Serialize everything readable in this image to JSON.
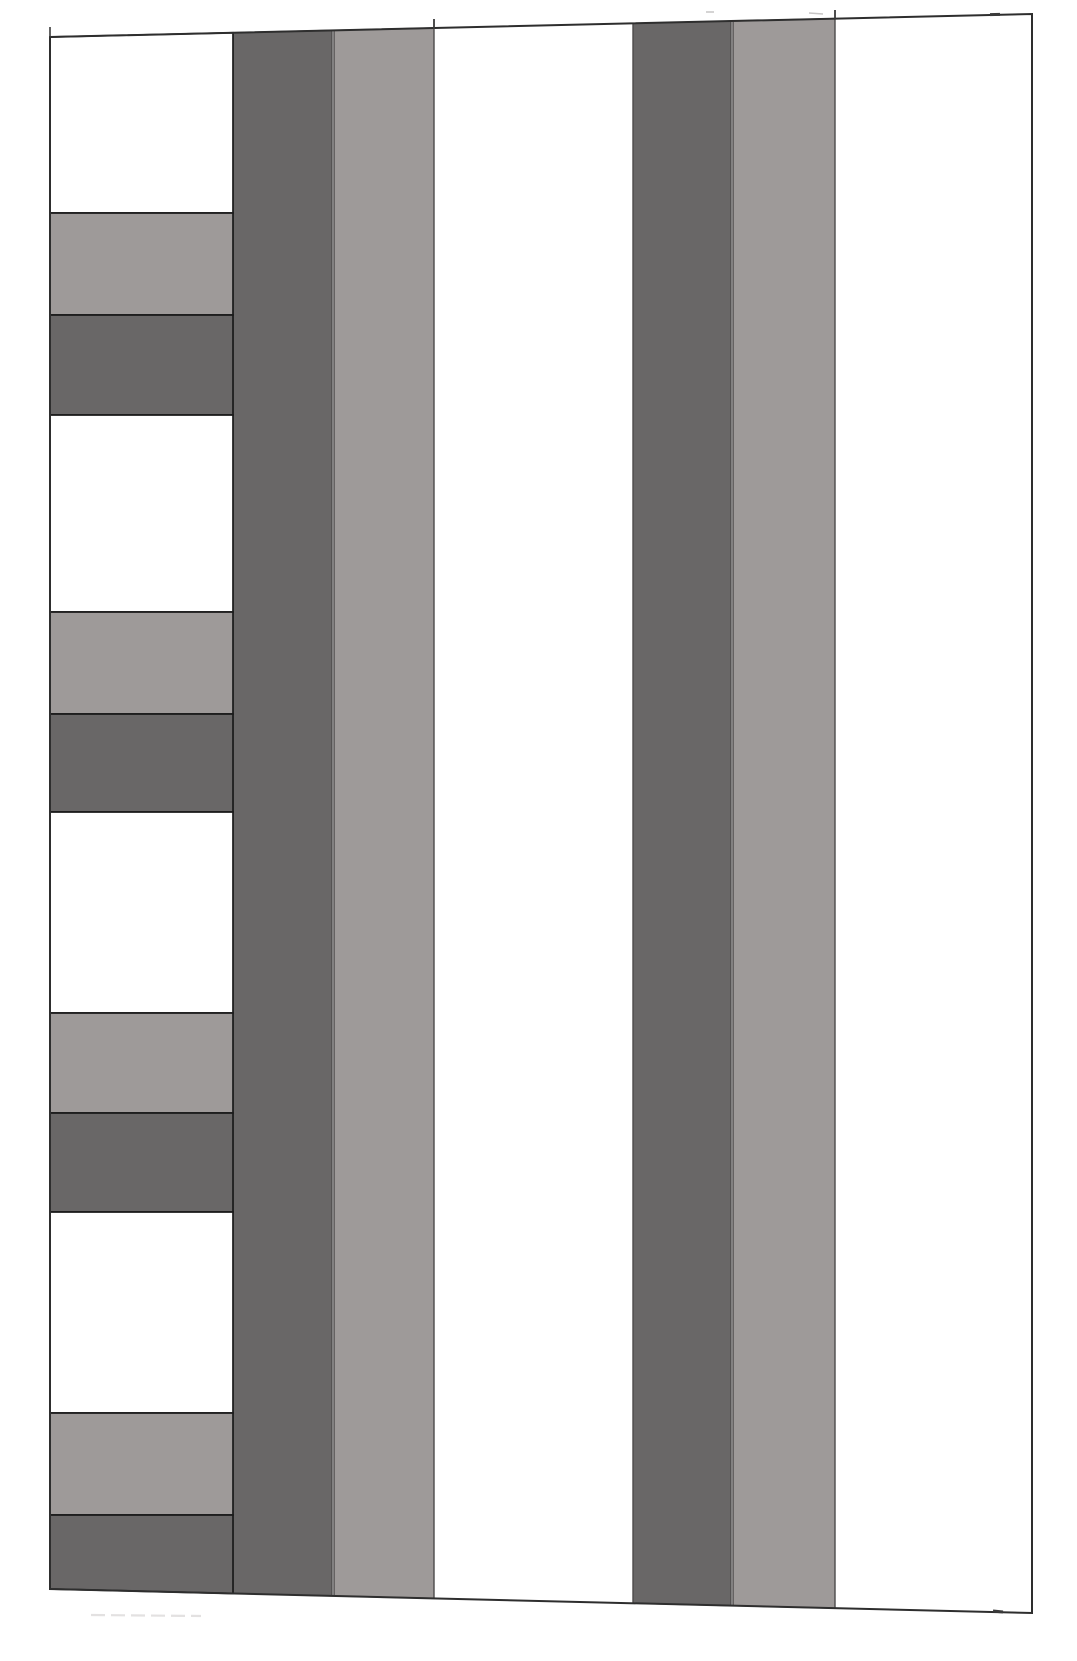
{
  "canvas": {
    "width": 1077,
    "height": 1661,
    "background": "#ffffff"
  },
  "colors": {
    "white": "#ffffff",
    "medium": "#9e9a99",
    "dark": "#696767",
    "band_stroke": "#1b1b1b",
    "stripe_stroke": "#4d4b4b",
    "outer_stroke": "#2e2e2e",
    "dark_line": "#3a3a3a",
    "faint_mark": "#c7c5c5",
    "faint_line": "#e3e1e1"
  },
  "outer_frame": {
    "top_left": [
      50,
      37
    ],
    "top_right": [
      1032,
      14
    ],
    "bottom_right": [
      1032,
      1613
    ],
    "bottom_left": [
      50,
      1589
    ],
    "stroke_width": 2
  },
  "left_column": {
    "x_left": 50,
    "x_right": 233,
    "stroke_width": 1.7,
    "bands": [
      {
        "tone": "white",
        "y_top": 37,
        "y_bottom": 213,
        "slope_top": true
      },
      {
        "tone": "medium",
        "y_top": 213,
        "y_bottom": 315
      },
      {
        "tone": "dark",
        "y_top": 315,
        "y_bottom": 415
      },
      {
        "tone": "white",
        "y_top": 415,
        "y_bottom": 612
      },
      {
        "tone": "medium",
        "y_top": 612,
        "y_bottom": 714
      },
      {
        "tone": "dark",
        "y_top": 714,
        "y_bottom": 812
      },
      {
        "tone": "white",
        "y_top": 812,
        "y_bottom": 1013
      },
      {
        "tone": "medium",
        "y_top": 1013,
        "y_bottom": 1113
      },
      {
        "tone": "dark",
        "y_top": 1113,
        "y_bottom": 1212
      },
      {
        "tone": "white",
        "y_top": 1212,
        "y_bottom": 1413
      },
      {
        "tone": "medium",
        "y_top": 1413,
        "y_bottom": 1515
      },
      {
        "tone": "dark",
        "y_top": 1515,
        "y_bottom": 1593,
        "slope_bottom": true
      }
    ]
  },
  "vertical_stripes": {
    "stroke_width": 1.4,
    "stripes": [
      {
        "tone": "dark",
        "x_left": 233,
        "x_right": 332
      },
      {
        "tone": "medium",
        "x_left": 334,
        "x_right": 434
      },
      {
        "tone": "dark",
        "x_left": 633,
        "x_right": 731
      },
      {
        "tone": "medium",
        "x_left": 733,
        "x_right": 835
      }
    ]
  },
  "artifacts": [
    {
      "name": "corner-tick-top-left",
      "x1": 50,
      "y1": 27,
      "x2": 50,
      "y2": 37,
      "stroke": "dark_line",
      "width": 1.6
    },
    {
      "name": "stripe-tick-top-medium-a",
      "x1": 434,
      "y1": 19,
      "x2": 434,
      "y2": 29,
      "stroke": "dark_line",
      "width": 1.8
    },
    {
      "name": "stripe-tick-top-medium-b",
      "x1": 835,
      "y1": 10,
      "x2": 835,
      "y2": 19,
      "stroke": "dark_line",
      "width": 1.8
    },
    {
      "name": "border-dash-top-right",
      "x1": 990,
      "y1": 14.6,
      "x2": 1000,
      "y2": 14.4,
      "stroke": "dark_line",
      "width": 3
    },
    {
      "name": "faint-dash-top-1",
      "x1": 706,
      "y1": 12,
      "x2": 714,
      "y2": 12,
      "stroke": "faint_mark",
      "width": 1.5
    },
    {
      "name": "faint-dash-top-2",
      "x1": 809,
      "y1": 13,
      "x2": 823,
      "y2": 14,
      "stroke": "faint_mark",
      "width": 1.5
    },
    {
      "name": "border-tick-bottom-right",
      "x1": 993,
      "y1": 1611,
      "x2": 1003,
      "y2": 1612,
      "stroke": "dark_line",
      "width": 3
    },
    {
      "name": "faint-line-bottom-left",
      "x1": 91,
      "y1": 1615,
      "x2": 201,
      "y2": 1616,
      "stroke": "faint_line",
      "width": 2.2,
      "dash": "14 6"
    }
  ]
}
